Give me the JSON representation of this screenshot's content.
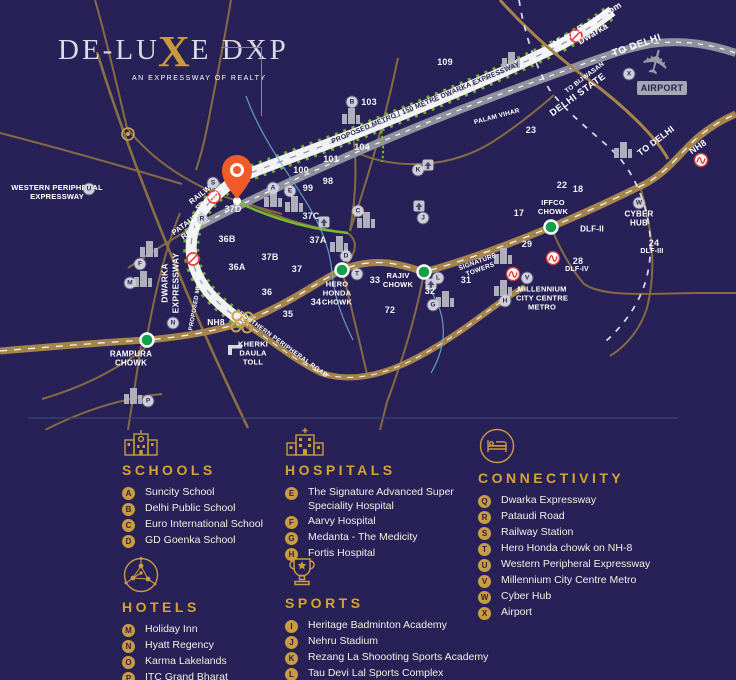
{
  "logo": {
    "part1": "DE-LU",
    "x": "X",
    "part2": "E DXP",
    "tagline": "AN EXPRESSWAY OF REALTY"
  },
  "icons": {
    "airplane": "✈"
  },
  "map": {
    "roads": {
      "metro_route": "Metro Route from Dwarka",
      "to_delhi_gray": "TO DELHI",
      "to_delhi_nh8": "TO DELHI",
      "nh8_ne": "NH8",
      "nh8_sw": "NH8",
      "to_bijwasan": "TO BIJWASAN",
      "delhi_state": "DELHI STATE",
      "palam_vihar": "PALAM VIHAR",
      "dwarka_expressway_label": "PROPOSED METRO / 150 METRE DWARKA EXPRESSWAY",
      "dwarka_expressway_side": "DWARKA EXPRESSWAY",
      "proposed_metro_side": "PROPOSED METRO",
      "southern_peripheral": "SOUTHERN PERIPHERAL ROAD",
      "western_peripheral": "WESTERN PERIPHERAL EXPRESSWAY",
      "pataudi_road": "PATAUDI ROAD",
      "railway_station": "RAILWAY STATION"
    },
    "places": {
      "airport": "AIRPORT",
      "cyber_hub": "CYBER HUB",
      "iffco_chowk": "IFFCO CHOWK",
      "rajiv_chowk": "RAJIV CHOWK",
      "hero_honda_chowk": "HERO HONDA CHOWK",
      "rampura_chowk": "RAMPURA CHOWK",
      "kherki_daula_toll": "KHERKI DAULA TOLL",
      "signature_towers": "SIGNATURE TOWERS",
      "millennium_metro": "MILLENNIUM CITY CENTRE METRO",
      "dlf2": "DLF-II",
      "dlf3": "DLF-III",
      "dlf4": "DLF-IV"
    },
    "sectors": {
      "n109": "109",
      "n23": "23",
      "n22": "22",
      "n103": "103",
      "n104": "104",
      "n101": "101",
      "n100": "100",
      "n99": "99",
      "n98": "98",
      "n37d": "37D",
      "n37c": "37C",
      "n37b": "37B",
      "n37a": "37A",
      "n37": "37",
      "n36b": "36B",
      "n36a": "36A",
      "n36": "36",
      "n35": "35",
      "n34": "34",
      "n33": "33",
      "n32": "32",
      "n31": "31",
      "n29": "29",
      "n28": "28",
      "n24": "24",
      "n18": "18",
      "n17": "17",
      "n72": "72"
    },
    "markers": {
      "a": "A",
      "b": "B",
      "c": "C",
      "d": "D",
      "e": "E",
      "f": "F",
      "g": "G",
      "h": "H",
      "j": "J",
      "k": "K",
      "l": "L",
      "m": "M",
      "n": "N",
      "p": "P",
      "r": "R",
      "s": "S",
      "t": "T",
      "u": "U",
      "v": "V",
      "w": "W",
      "x": "X"
    }
  },
  "legend": {
    "schools": {
      "title": "SCHOOLS",
      "items": [
        {
          "key": "A",
          "label": "Suncity School"
        },
        {
          "key": "B",
          "label": "Delhi Public School"
        },
        {
          "key": "C",
          "label": "Euro International School"
        },
        {
          "key": "D",
          "label": "GD Goenka School"
        }
      ]
    },
    "hospitals": {
      "title": "HOSPITALS",
      "items": [
        {
          "key": "E",
          "label": "The Signature Advanced Super Speciality Hospital"
        },
        {
          "key": "F",
          "label": "Aarvy Hospital"
        },
        {
          "key": "G",
          "label": "Medanta - The Medicity"
        },
        {
          "key": "H",
          "label": "Fortis Hospital"
        }
      ]
    },
    "connectivity": {
      "title": "CONNECTIVITY",
      "items": [
        {
          "key": "Q",
          "label": "Dwarka Expressway"
        },
        {
          "key": "R",
          "label": "Pataudi Road"
        },
        {
          "key": "S",
          "label": "Railway Station"
        },
        {
          "key": "T",
          "label": "Hero Honda chowk on NH-8"
        },
        {
          "key": "U",
          "label": "Western Peripheral Expressway"
        },
        {
          "key": "V",
          "label": "Millennium City Centre Metro"
        },
        {
          "key": "W",
          "label": "Cyber Hub"
        },
        {
          "key": "X",
          "label": "Airport"
        }
      ]
    },
    "hotels": {
      "title": "HOTELS",
      "items": [
        {
          "key": "M",
          "label": "Holiday Inn"
        },
        {
          "key": "N",
          "label": "Hyatt Regency"
        },
        {
          "key": "O",
          "label": "Karma Lakelands"
        },
        {
          "key": "P",
          "label": "ITC Grand Bharat"
        }
      ]
    },
    "sports": {
      "title": "SPORTS",
      "items": [
        {
          "key": "I",
          "label": "Heritage Badminton Academy"
        },
        {
          "key": "J",
          "label": "Nehru Stadium"
        },
        {
          "key": "K",
          "label": "Rezang La Shoooting Sports Academy"
        },
        {
          "key": "L",
          "label": "Tau Devi Lal Sports Complex"
        }
      ]
    }
  },
  "colors": {
    "background": "#282157",
    "road_gold": "#a5854c",
    "road_white": "#f3f3f6",
    "road_gray": "#90929f",
    "accent_gold": "#c99c3f",
    "green": "#79bc2b",
    "pin_orange": "#f15a29",
    "marker_red": "#d93a3a"
  }
}
